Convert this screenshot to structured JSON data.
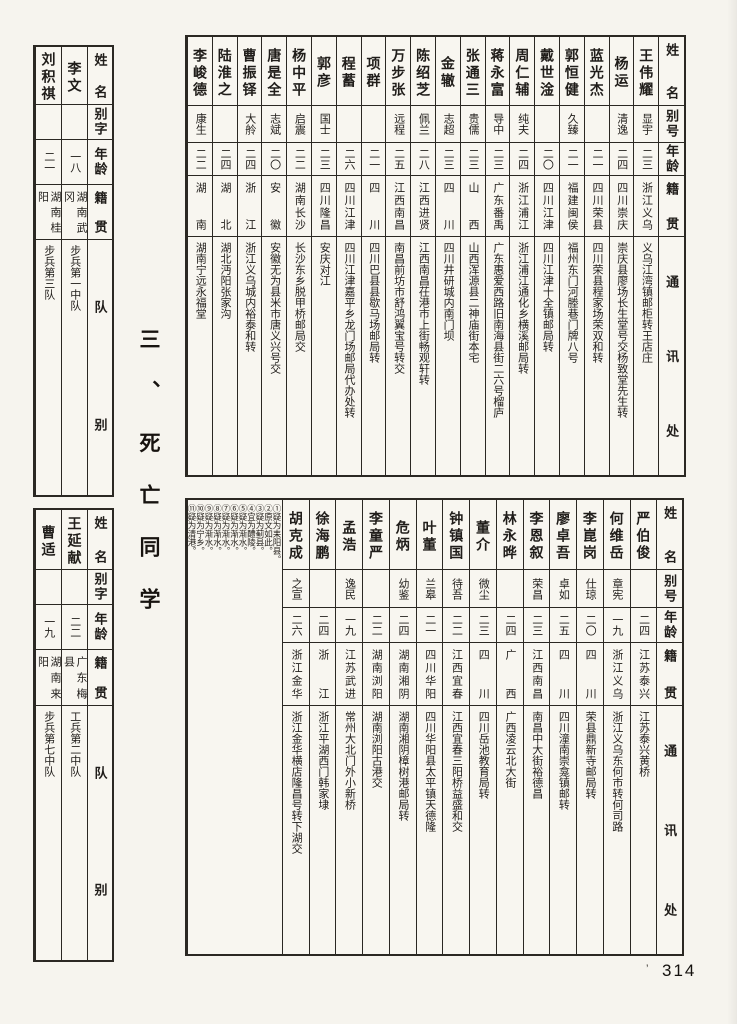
{
  "page": {
    "title": "三、死亡同学",
    "page_number": "314",
    "speck": "’"
  },
  "roster_headers": {
    "name": "姓名",
    "alias": "别号",
    "age": "年龄",
    "origin": "籍贯",
    "contact": "通讯处"
  },
  "squad_headers": {
    "name": "姓名",
    "alias": "别字",
    "age": "年龄",
    "origin": "籍贯",
    "squad": "队别"
  },
  "top_table": {
    "people": [
      {
        "name": "王伟耀",
        "alias": "显宇",
        "age": "二三",
        "origin": "浙江义乌",
        "contact": "义乌江湾镇邮柜转王店庄"
      },
      {
        "name": "杨运",
        "alias": "清逸",
        "age": "二四",
        "origin": "四川崇庆",
        "contact": "崇庆县廖场长生堂号交杨致堂先生转"
      },
      {
        "name": "蓝光杰",
        "alias": "",
        "age": "二一",
        "origin": "四川荣县",
        "contact": "四川荣县程家场荣双和转"
      },
      {
        "name": "郭恒健",
        "alias": "久臻",
        "age": "二一",
        "origin": "福建闽侯",
        "contact": "福州东门河塍巷门牌八号"
      },
      {
        "name": "戴世淦",
        "alias": "",
        "age": "二〇",
        "origin": "四川江津",
        "contact": "四川江津十全镇邮局转"
      },
      {
        "name": "周仁辅",
        "alias": "纯夫",
        "age": "二四",
        "origin": "浙江浦江",
        "contact": "浙江浦江通化乡横溪邮局转"
      },
      {
        "name": "蒋永富",
        "alias": "导中",
        "age": "二三",
        "origin": "广东番禹",
        "contact": "广东惠爱西路旧南海县街二六号榴庐"
      },
      {
        "name": "张通三",
        "alias": "贵儒",
        "age": "二三",
        "origin": "山西",
        "contact": "山西浑源县二神庙街本宅"
      },
      {
        "name": "金辙",
        "alias": "志超",
        "age": "二三",
        "origin": "四川",
        "contact": "四川井研城内南门坝"
      },
      {
        "name": "陈绍芝",
        "alias": "佩兰",
        "age": "二八",
        "origin": "江西进贤",
        "contact": "江西南昌茌港市上街畅观轩转"
      },
      {
        "name": "万步张",
        "alias": "远程",
        "age": "二五",
        "origin": "江西南昌",
        "contact": "南昌前坊市舒鸿翼宝号转交"
      },
      {
        "name": "项群",
        "alias": "",
        "age": "二一",
        "origin": "四川",
        "contact": "四川巴县县歇马场邮局转"
      },
      {
        "name": "程蓄",
        "alias": "",
        "age": "二六",
        "origin": "四川江津",
        "contact": "四川江津嘉平乡龙门场邮局代办处转"
      },
      {
        "name": "郭彦",
        "alias": "国士",
        "age": "二三",
        "origin": "四川隆昌",
        "contact": "安庆对江"
      },
      {
        "name": "杨中平",
        "alias": "启震",
        "age": "二二",
        "origin": "湖南长沙",
        "contact": "长沙东乡脱甲桥邮局交"
      },
      {
        "name": "唐是全",
        "alias": "志斌",
        "age": "二〇",
        "origin": "安徽",
        "contact": "安徽无为县米市唐义兴号交"
      },
      {
        "name": "曹振铎",
        "alias": "大舲",
        "age": "二四",
        "origin": "浙江",
        "contact": "浙江义乌城内裕泰和转"
      },
      {
        "name": "陆淮之",
        "alias": "",
        "age": "二四",
        "origin": "湖北",
        "contact": "湖北沔阳张家沟"
      },
      {
        "name": "李峻德",
        "alias": "康生",
        "age": "二二",
        "origin": "湖南",
        "contact": "湖南宁远永福堂"
      }
    ]
  },
  "bottom_table": {
    "people": [
      {
        "name": "严伯俊",
        "alias": "",
        "age": "二四",
        "origin": "江苏泰兴",
        "contact": "江苏泰兴黄桥"
      },
      {
        "name": "何维岳",
        "alias": "章宪",
        "age": "一九",
        "origin": "浙江义乌",
        "contact": "浙江义乌东何市转何司路"
      },
      {
        "name": "李崑岗",
        "alias": "仕琼",
        "age": "二〇",
        "origin": "四川",
        "contact": "荣县鼎新寺邮局转"
      },
      {
        "name": "廖卓吾",
        "alias": "卓如",
        "age": "二五",
        "origin": "四川",
        "contact": "四川潼南崇龛镇邮转"
      },
      {
        "name": "李恩叙",
        "alias": "荣昌",
        "age": "二三",
        "origin": "江西南昌",
        "contact": "南昌中大街裕德昌"
      },
      {
        "name": "林永晔",
        "alias": "",
        "age": "二四",
        "origin": "广西",
        "contact": "广西凌云北大街"
      },
      {
        "name": "董介",
        "alias": "微尘",
        "age": "二三",
        "origin": "四川",
        "contact": "四川岳池教育局转"
      },
      {
        "name": "钟镇国",
        "alias": "待吾",
        "age": "二二",
        "origin": "江西宜春",
        "contact": "江西宜春三阳桥益盛和交"
      },
      {
        "name": "叶董",
        "alias": "兰皋",
        "age": "二一",
        "origin": "四川华阳",
        "contact": "四川华阳县太平镇天德隆"
      },
      {
        "name": "危炳",
        "alias": "幼鉴",
        "age": "二四",
        "origin": "湖南湘阴",
        "contact": "湖南湘阴樟树港邮局转"
      },
      {
        "name": "李童严",
        "alias": "",
        "age": "二二",
        "origin": "湖南浏阳",
        "contact": "湖南浏阳古港交"
      },
      {
        "name": "孟浩",
        "alias": "逸民",
        "age": "一九",
        "origin": "江苏武进",
        "contact": "常州大北门外小新桥"
      },
      {
        "name": "徐海鹏",
        "alias": "",
        "age": "二四",
        "origin": "浙江",
        "contact": "浙江平湖西门韩家埭"
      },
      {
        "name": "胡克成",
        "alias": "之宣",
        "age": "二六",
        "origin": "浙江金华",
        "contact": "浙江金华横店隆昌号转下湖交"
      }
    ],
    "footnotes": [
      {
        "label": "①疑为耒阳县。"
      },
      {
        "label": "②原文如此。"
      },
      {
        "label": "③疑为蓟县。"
      },
      {
        "label": "④宜为醴陵。"
      },
      {
        "label": "⑤疑为渐水。"
      },
      {
        "label": "⑥疑为渐水。"
      },
      {
        "label": "⑦疑为渐水。"
      },
      {
        "label": "⑧疑为渐水。"
      },
      {
        "label": "⑨疑为渐水。"
      },
      {
        "label": "⑩疑为宁乡。"
      },
      {
        "label": "⑪疑为清港。"
      }
    ]
  },
  "left_top_table": {
    "people": [
      {
        "name": "李文",
        "alias": "",
        "age": "一八",
        "origin": "湖南武冈",
        "squad": "步兵第一中队"
      },
      {
        "name": "刘积祺",
        "alias": "",
        "age": "二一",
        "origin": "湖南桂阳",
        "squad": "步兵第三队"
      }
    ]
  },
  "left_bottom_table": {
    "people": [
      {
        "name": "王延献",
        "alias": "",
        "age": "二二",
        "origin": "广东梅县",
        "squad": "工兵第二中队"
      },
      {
        "name": "曹适",
        "alias": "",
        "age": "一九",
        "origin": "湖南来阳",
        "squad": "步兵第七中队"
      }
    ]
  }
}
